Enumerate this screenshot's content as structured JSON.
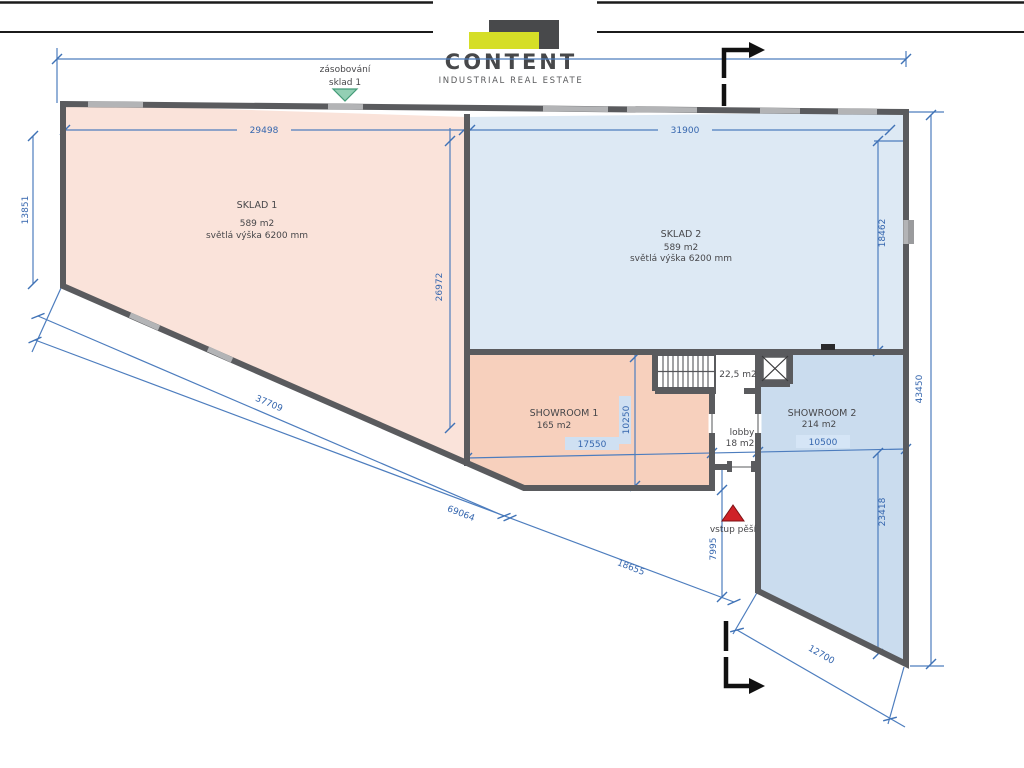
{
  "logo": {
    "brand": "CONTENT",
    "tagline": "INDUSTRIAL REAL ESTATE",
    "colors": {
      "accent_yellow": "#d5de27",
      "dark_gray": "#48494b"
    }
  },
  "plan": {
    "rooms": [
      {
        "id": "sklad1",
        "name": "SKLAD 1",
        "area": "589 m2",
        "note": "světlá výška 6200 mm",
        "fill": "#fae3da"
      },
      {
        "id": "sklad2",
        "name": "SKLAD 2",
        "area": "589 m2",
        "note": "světlá výška 6200 mm",
        "fill": "#dde9f4"
      },
      {
        "id": "showroom1",
        "name": "SHOWROOM 1",
        "area": "165 m2",
        "fill": "#f7d0bd"
      },
      {
        "id": "showroom2",
        "name": "SHOWROOM 2",
        "area": "214 m2",
        "fill": "#cadcee"
      },
      {
        "id": "stair-room",
        "area": "22,5 m2",
        "fill": "#ffffff"
      },
      {
        "id": "lobby",
        "name": "lobby",
        "area": "18 m2",
        "fill": "#ffffff"
      }
    ],
    "annotations": {
      "supply_line1": "zásobování",
      "supply_line2": "sklad 1",
      "entry": "vstup pěší"
    },
    "dimensions": {
      "sklad1_width": "29498",
      "sklad2_width": "31900",
      "left_height": "13851",
      "sklad1_inner_height": "26972",
      "sklad2_inner_height": "18462",
      "right_total_height": "43450",
      "showroom1_height": "10250",
      "showroom1_width": "17550",
      "showroom2_width": "10500",
      "showroom2_lower_height": "23418",
      "entry_depth": "7995",
      "diagonal_upper": "37709",
      "diagonal_total": "69064",
      "diagonal_lower": "18655",
      "bottom_edge": "12700"
    },
    "colors": {
      "dimension_blue": "#4d7dbe",
      "wall_gray": "#5a5b5e",
      "supply_green": "#93cfb4",
      "entry_red": "#cf2127"
    }
  }
}
